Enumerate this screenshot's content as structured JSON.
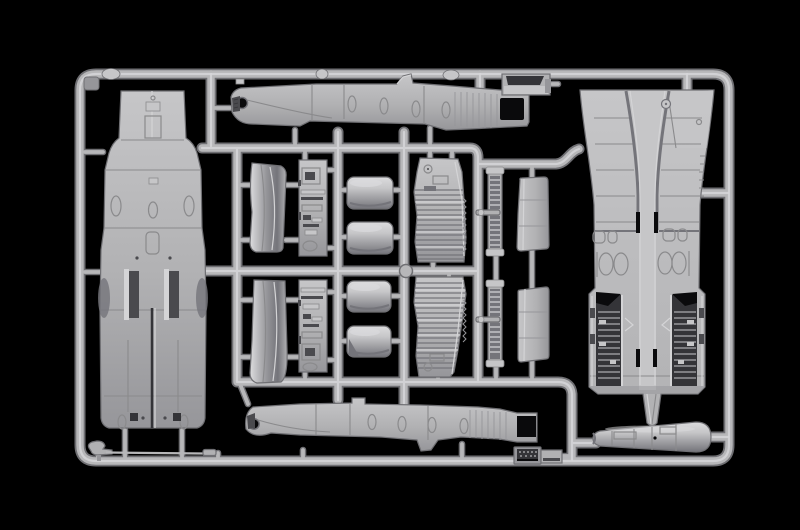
{
  "scene": {
    "subject": "injection-molded model kit sprue with light grey aircraft parts photographed on black",
    "background_color": "#000000"
  },
  "palette": {
    "background": "#000000",
    "plastic_hi": "#dcdcde",
    "plastic_light": "#c6c6c8",
    "plastic_base": "#b1b1b3",
    "plastic_mid": "#96969a",
    "plastic_shadow": "#74747a",
    "line_dark": "#8a8a8c",
    "line_light": "#d4d4d6",
    "deep_shadow": "#4a4a4e",
    "recess": "#343438",
    "hole_black": "#0a0a0c",
    "runner_edge": "#6f6f73",
    "runner_core": "#b7b7b9",
    "runner_highlight": "#d6d6d8"
  },
  "parts": [
    "sprue-frame",
    "aft-fuselage-half",
    "fuselage-side-half-upper",
    "fuselage-side-half-lower",
    "intake-ramp-upper",
    "intake-ramp-lower",
    "cockpit-sidewall-upper",
    "cockpit-sidewall-lower",
    "intake-duct-halves-upper",
    "intake-duct-halves-lower",
    "corrugated-flap-upper",
    "corrugated-flap-lower",
    "actuator-strip-upper",
    "actuator-strip-lower",
    "wing-root-wedge-upper",
    "wing-root-wedge-lower",
    "intake-box",
    "wing-center-section",
    "engine-nacelle",
    "instrument-panel",
    "pitot-boom"
  ]
}
